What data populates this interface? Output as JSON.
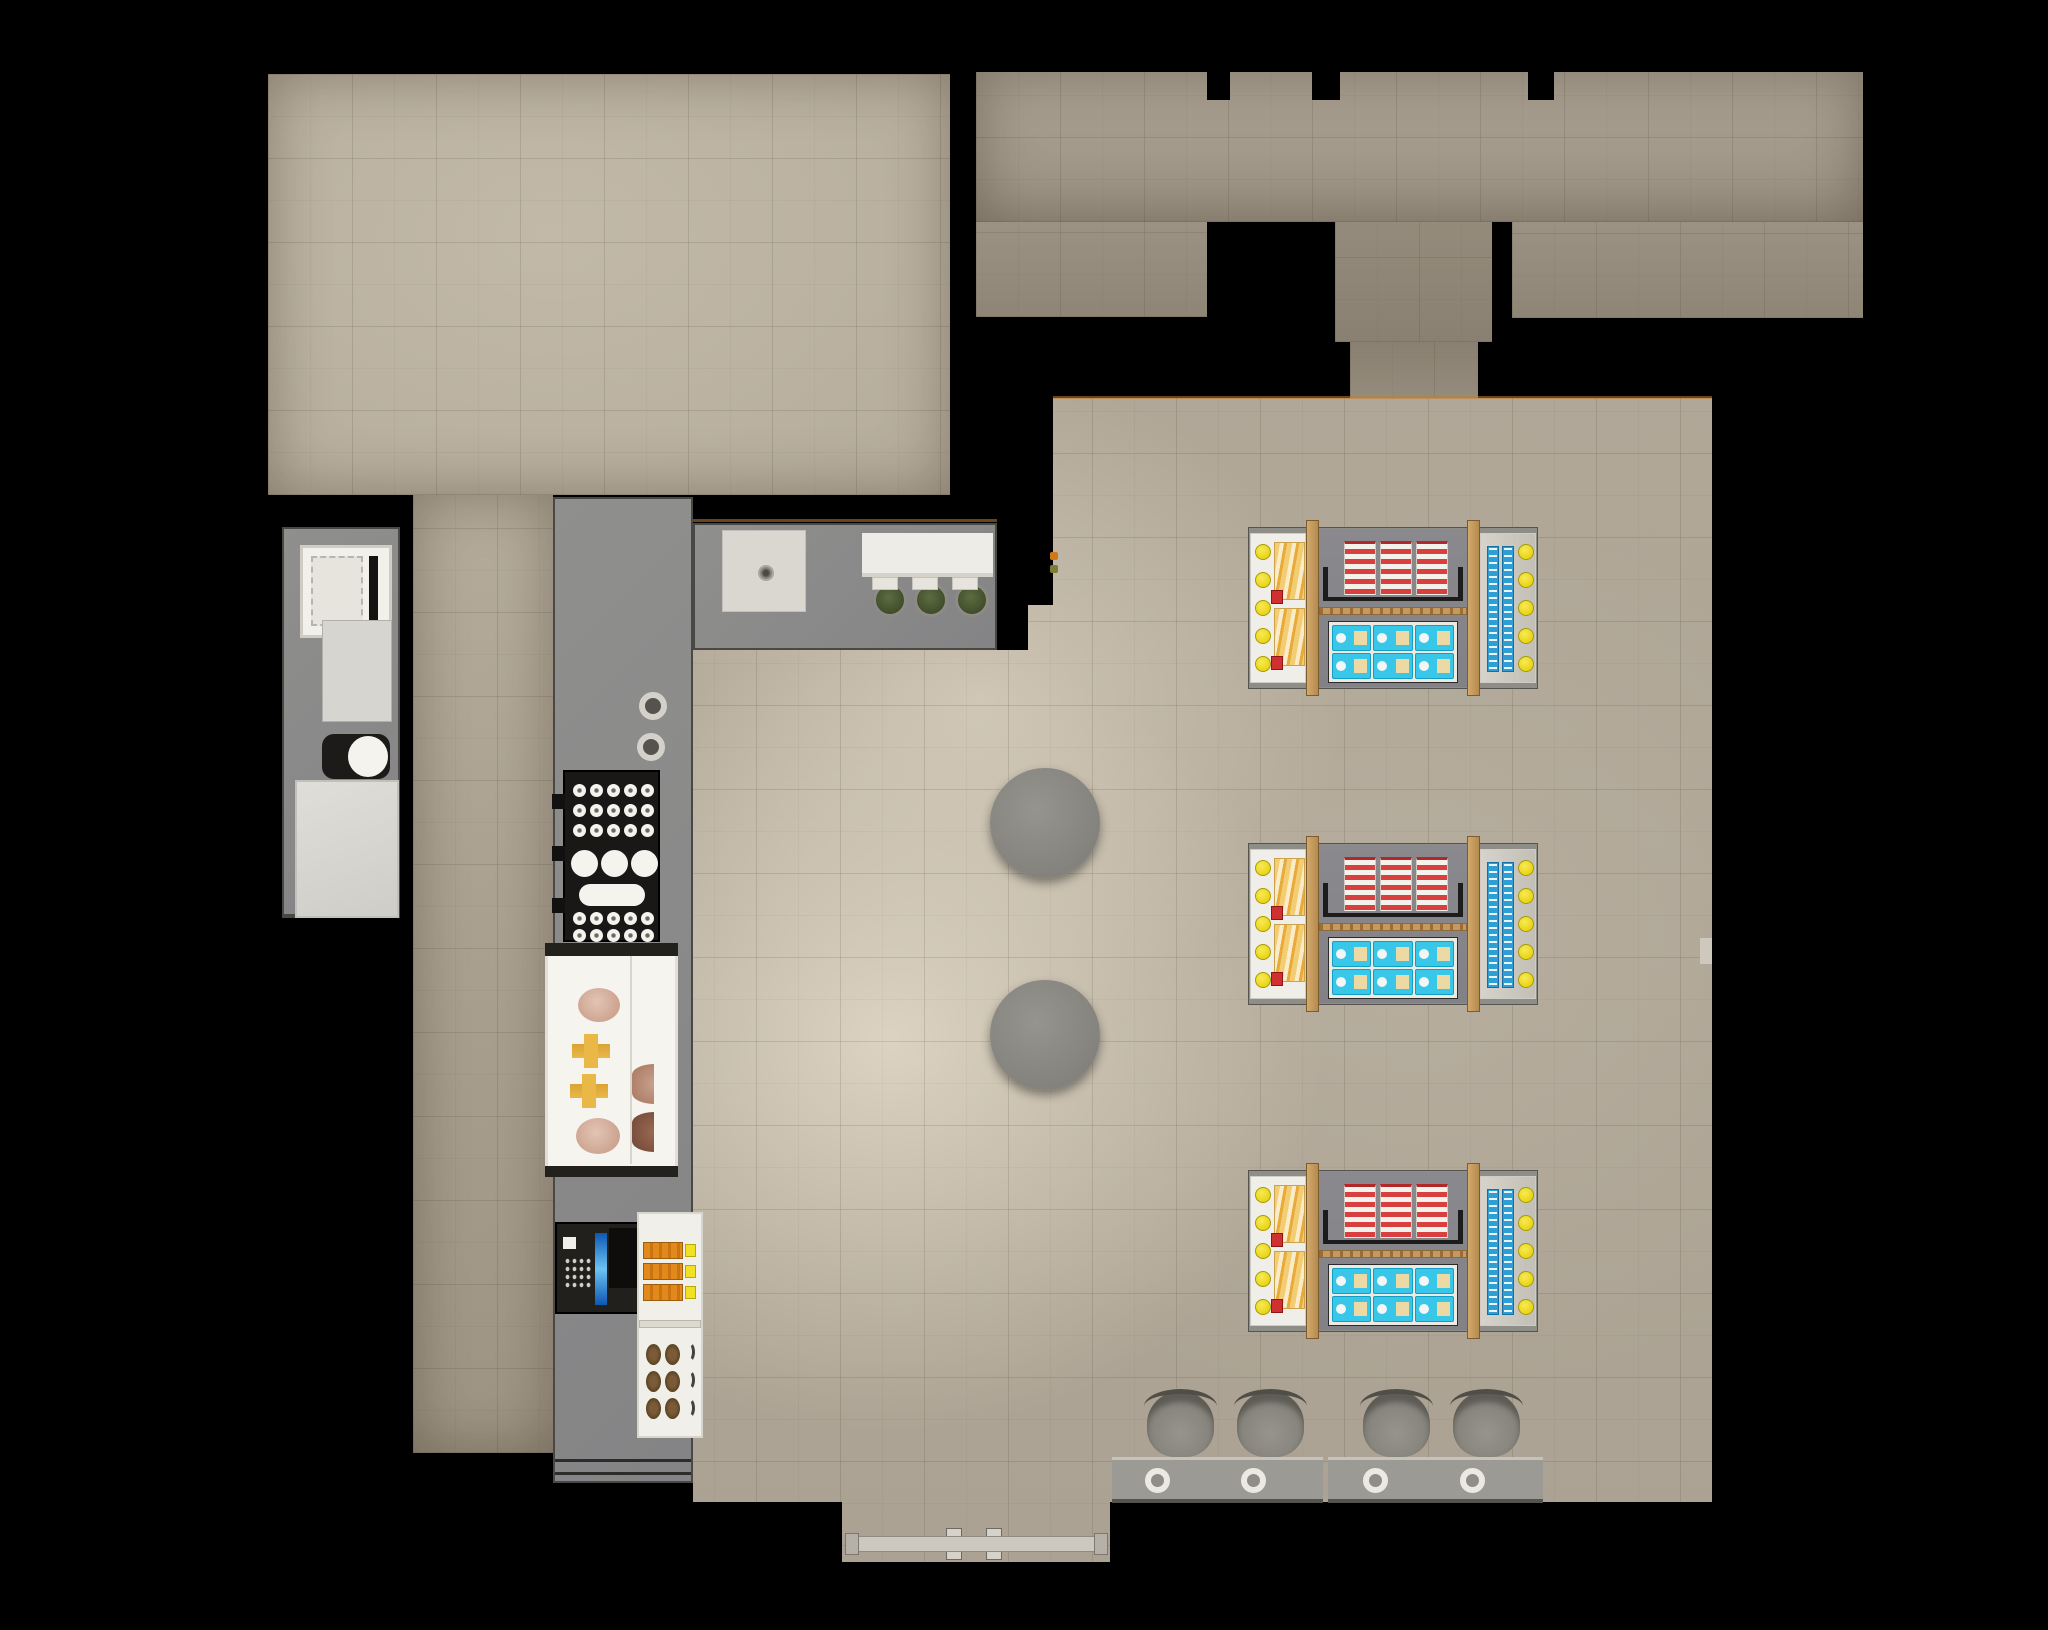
{
  "scene": {
    "type": "architectural floor plan render",
    "view": "top-down",
    "setting": "cafe and convenience retail space with kitchen, service counters, retail gondolas, seating and entrance"
  },
  "palette": {
    "background": "#000000",
    "floor_room": "#b7ae9e",
    "floor_main": "#b0a797",
    "floor_light_center": "#dcd3c1",
    "floor_corridor": "#968c7d",
    "counter_gray": "#8a8a88",
    "counter_edge": "#4a4844",
    "appliance_white": "#f2f0ea",
    "box_light_gray": "#d7d5cf",
    "tray_black": "#1a1816",
    "cup_white": "#f4f3ee",
    "case_white": "#f6f4ef",
    "pastry_pink": "#d9b5a4",
    "pastry_yellow": "#e9b847",
    "pastry_brown": "#7a5a38",
    "pos_black": "#21201d",
    "pos_screen_blue": "#6cc4f2",
    "pack_orange": "#e2891c",
    "cap_yellow": "#f2e023",
    "gondola_pad": "#8e8d88",
    "endcap_white": "#f0eee8",
    "wood_tan": "#c39a60",
    "product_red": "#d84040",
    "product_white": "#f5f2ec",
    "product_cyan": "#38c6e9",
    "product_tan": "#ecd9a4",
    "bottle_blue": "#2f9ed5",
    "ball_yellow": "#e8d312",
    "label_red": "#d03030",
    "olive_pot": "#3e4b2b",
    "table_gray": "#8b8b85",
    "door_rail": "#ccc8bf",
    "accent_orange": "#c07828"
  },
  "rooms": {
    "top_left_room": "empty tiled room",
    "top_right_rooms": "back rooms with corridor to sales floor",
    "corridor_left": "kitchen aisle",
    "main_room": "sales floor and seating area"
  },
  "fixtures": {
    "left_counter": [
      "white appliance with vent slot",
      "gray prep box",
      "mixer with white bowl",
      "large light worktop"
    ],
    "top_counter": [
      "drain square",
      "white back shelf",
      "green pots"
    ],
    "mid_counter": [
      "hotplate burners",
      "cup tray",
      "pastry display case",
      "POS terminal with blue screen",
      "snack shelf unit"
    ]
  },
  "top_counter": {
    "green_pots": 3
  },
  "burners": 2,
  "cup_tray": {
    "small_top_rows": 3,
    "small_cols": 5,
    "large_circles": 3,
    "oblong_dishes": 1,
    "small_bottom_rows": 2,
    "handles": 3
  },
  "display_case": {
    "pink_plates": 2,
    "yellow_pastries": 2,
    "side_plates": 2
  },
  "shelf_unit": {
    "orange_packs": 3,
    "croissant_rows": 3,
    "croissant_cols": 2,
    "wavy_racks": 3
  },
  "gondolas": {
    "x": 1248,
    "width": 290,
    "height": 162,
    "rows": [
      {
        "y": 527
      },
      {
        "y": 843
      },
      {
        "y": 1170
      }
    ],
    "endcap_balls_per_side": 5,
    "snack_packs_per_left_cap": 2,
    "red_box_columns": 3,
    "cyan_packs": {
      "rows": 2,
      "cols": 3
    },
    "bottle_columns": 2
  },
  "seating": {
    "round_tables": [
      {
        "cx": 1045,
        "cy": 823
      },
      {
        "cx": 1045,
        "cy": 1035
      }
    ],
    "chairs_x": [
      1147,
      1237,
      1363,
      1453
    ],
    "chairs_y": 1391,
    "bar_tables": [
      {
        "x": 1112,
        "w": 211
      },
      {
        "x": 1328,
        "w": 215
      }
    ],
    "table_rings_cx": [
      1157,
      1253,
      1375,
      1472
    ]
  },
  "entrance": {
    "door_handles": 2,
    "vestibule": "bottom center protrusion with sliding door rail"
  }
}
